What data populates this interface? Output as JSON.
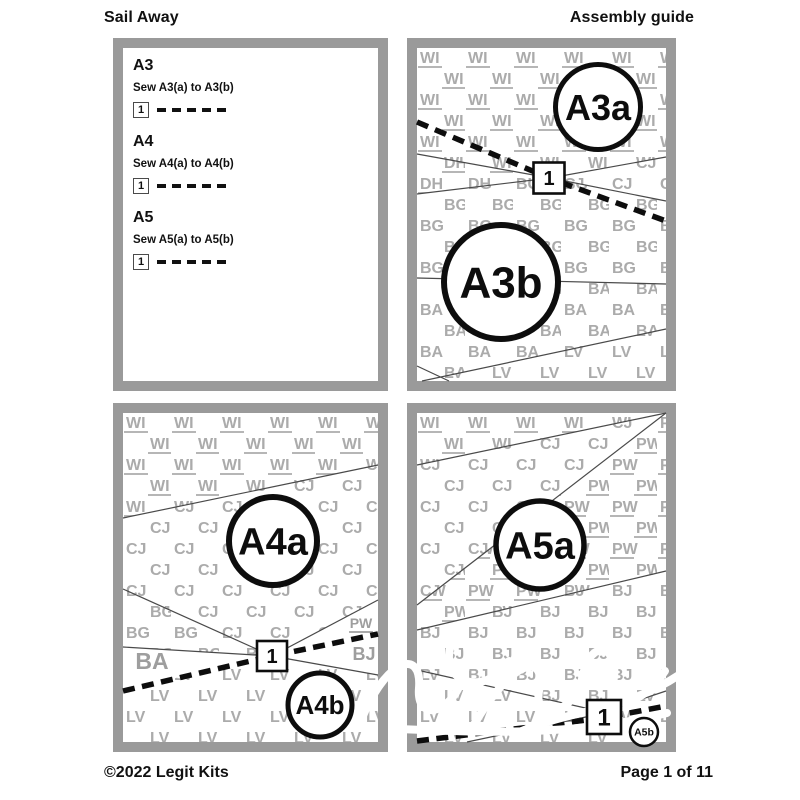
{
  "header": {
    "title": "Sail Away",
    "subtitle": "Assembly guide"
  },
  "footer": {
    "copyright": "©2022 Legit Kits",
    "page": "Page 1 of 11"
  },
  "instructions": [
    {
      "heading": "A3",
      "text": "Sew A3(a) to A3(b)",
      "step": "1"
    },
    {
      "heading": "A4",
      "text": "Sew A4(a) to A4(b)",
      "step": "1"
    },
    {
      "heading": "A5",
      "text": "Sew A5(a) to A5(b)",
      "step": "1"
    }
  ],
  "colors": {
    "panel_border": "#9a9a9a",
    "tile": "#ababab",
    "label_gray": "#9e9e9e",
    "seam": "#4a4a4a",
    "ink": "#0d0d0d",
    "white": "#ffffff"
  },
  "panels": [
    {
      "id": "a3-diagram",
      "iw": 249,
      "ih": 333,
      "regions": [
        {
          "code": "WI",
          "underline": true,
          "points": "0,0 249,0 249,109 133,130 0,106"
        },
        {
          "code": "DH",
          "underline": true,
          "points": "0,106 133,130 0,146"
        },
        {
          "code": "CJ",
          "underline": false,
          "points": "133,130 249,109 249,153"
        },
        {
          "code": "BG",
          "underline": false,
          "points": "0,146 133,130 249,153 249,236 0,230"
        },
        {
          "code": "BA",
          "underline": false,
          "points": "0,230 249,236 249,281 5,333 0,333"
        },
        {
          "code": "LV",
          "underline": false,
          "points": "5,333 249,281 249,333"
        }
      ],
      "labels": [],
      "seams": [
        [
          0,
          106,
          133,
          130
        ],
        [
          0,
          146,
          133,
          130
        ],
        [
          133,
          130,
          249,
          109
        ],
        [
          133,
          130,
          249,
          153
        ],
        [
          0,
          230,
          249,
          236
        ],
        [
          5,
          333,
          249,
          281
        ],
        [
          0,
          318,
          32,
          333
        ]
      ],
      "dash": [
        [
          0,
          74
        ],
        [
          132,
          130
        ],
        [
          249,
          173
        ]
      ],
      "circles": [
        {
          "label": "A3a",
          "cx": 181,
          "cy": 59,
          "r": 42.5,
          "sw": 5,
          "fs": 36
        },
        {
          "label": "A3b",
          "cx": 84,
          "cy": 234,
          "r": 57,
          "sw": 6,
          "fs": 44
        }
      ],
      "step": {
        "label": "1",
        "cx": 132,
        "cy": 130,
        "size": 31,
        "fs": 20
      },
      "watermark": false
    },
    {
      "id": "a4-diagram",
      "iw": 255,
      "ih": 329,
      "regions": [
        {
          "code": "WI",
          "underline": true,
          "points": "0,0 255,0 255,52 0,105"
        },
        {
          "code": "CJ",
          "underline": false,
          "points": "0,105 255,52 255,187 149,243 0,176"
        },
        {
          "code": "BG",
          "underline": false,
          "points": "0,176 149,243 0,234"
        },
        {
          "code": "LV",
          "underline": false,
          "points": "0,277 149,243 255,262 255,329 0,329"
        }
      ],
      "labels": [
        {
          "text": "BA",
          "x": 29,
          "y": 256,
          "fs": 23,
          "underline": false
        },
        {
          "text": "PW",
          "x": 238,
          "y": 215,
          "fs": 14,
          "underline": true
        },
        {
          "text": "BJ",
          "x": 241,
          "y": 247,
          "fs": 18,
          "underline": false
        }
      ],
      "seams": [
        [
          0,
          105,
          255,
          52
        ],
        [
          0,
          176,
          149,
          243
        ],
        [
          0,
          234,
          149,
          243
        ],
        [
          149,
          243,
          255,
          187
        ],
        [
          149,
          243,
          255,
          262
        ]
      ],
      "dash": [
        [
          0,
          278
        ],
        [
          149,
          243
        ],
        [
          255,
          221
        ]
      ],
      "circles": [
        {
          "label": "A4a",
          "cx": 150,
          "cy": 128,
          "r": 44,
          "sw": 6,
          "fs": 38
        },
        {
          "label": "A4b",
          "cx": 197,
          "cy": 292,
          "r": 32,
          "sw": 5,
          "fs": 26
        }
      ],
      "step": {
        "label": "1",
        "cx": 149,
        "cy": 243,
        "size": 30,
        "fs": 20
      },
      "watermark": false
    },
    {
      "id": "a5-diagram",
      "iw": 249,
      "ih": 329,
      "regions": [
        {
          "code": "WI",
          "underline": true,
          "points": "0,0 249,0 0,52"
        },
        {
          "code": "CJ",
          "underline": false,
          "points": "0,52 249,0 0,192"
        },
        {
          "code": "PW",
          "underline": true,
          "points": "249,0 249,158 0,217 0,192"
        },
        {
          "code": "BJ",
          "underline": false,
          "points": "0,217 249,158 249,278 186,299 0,257"
        },
        {
          "code": "LV",
          "underline": false,
          "points": "0,257 186,299 249,278 249,329 0,329"
        }
      ],
      "labels": [],
      "seams": [
        [
          0,
          52,
          249,
          0
        ],
        [
          0,
          192,
          249,
          0
        ],
        [
          0,
          217,
          249,
          158
        ],
        [
          0,
          257,
          186,
          299
        ],
        [
          186,
          299,
          249,
          278
        ],
        [
          50,
          329,
          183,
          301
        ],
        [
          204,
          306,
          240,
          320
        ]
      ],
      "dash": [
        [
          0,
          328
        ],
        [
          186,
          305
        ],
        [
          249,
          293
        ]
      ],
      "circles": [
        {
          "label": "A5a",
          "cx": 123,
          "cy": 132,
          "r": 44,
          "sw": 5.5,
          "fs": 38
        },
        {
          "label": "A5b",
          "cx": 227,
          "cy": 319,
          "r": 14,
          "sw": 2.5,
          "fs": 10.5
        }
      ],
      "step": {
        "label": "1",
        "cx": 187,
        "cy": 304,
        "size": 34,
        "fs": 24
      },
      "watermark": true,
      "watermark_paths": [
        "M -55 305 C -30 245 5 235 2 275 C -1 312 38 300 48 258 C 58 218 34 214 32 242 C 30 272 70 282 92 248",
        "M 55 315 C 95 245 130 238 122 278 C 116 310 158 302 166 262 C 174 224 204 232 196 270 C 190 300 224 294 248 258",
        "M 96 322 C 150 296 205 300 262 262",
        "M -20 316 C 40 318 150 326 250 300"
      ]
    }
  ]
}
